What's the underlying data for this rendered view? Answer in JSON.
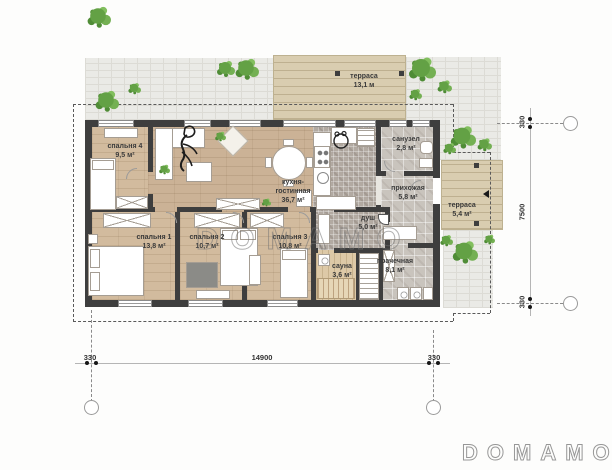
{
  "watermark": {
    "center": "DOMAMO",
    "corner": "DOMAMO"
  },
  "rooms": [
    {
      "name": "спальня 4",
      "area": "9,5 м²"
    },
    {
      "name": "кухня-гостинная",
      "area": "36,7 м²"
    },
    {
      "name": "санузел",
      "area": "2,8 м²"
    },
    {
      "name": "прихожая",
      "area": "5,8 м²"
    },
    {
      "name": "душ",
      "area": "5,0 м²"
    },
    {
      "name": "спальня 1",
      "area": "13,8 м²"
    },
    {
      "name": "спальня 2",
      "area": "10,7 м²"
    },
    {
      "name": "спальня 3",
      "area": "10,8 м²"
    },
    {
      "name": "сауна",
      "area": "3,6 м²"
    },
    {
      "name": "прачечная",
      "area": "8,1 м²"
    }
  ],
  "terraces": [
    {
      "name": "терраса",
      "area": "13,1 м"
    },
    {
      "name": "терраса",
      "area": "5,4 м²"
    }
  ],
  "dimensions": {
    "bottom": [
      "330",
      "14900",
      "330"
    ],
    "right": [
      "330",
      "7500",
      "330"
    ]
  }
}
